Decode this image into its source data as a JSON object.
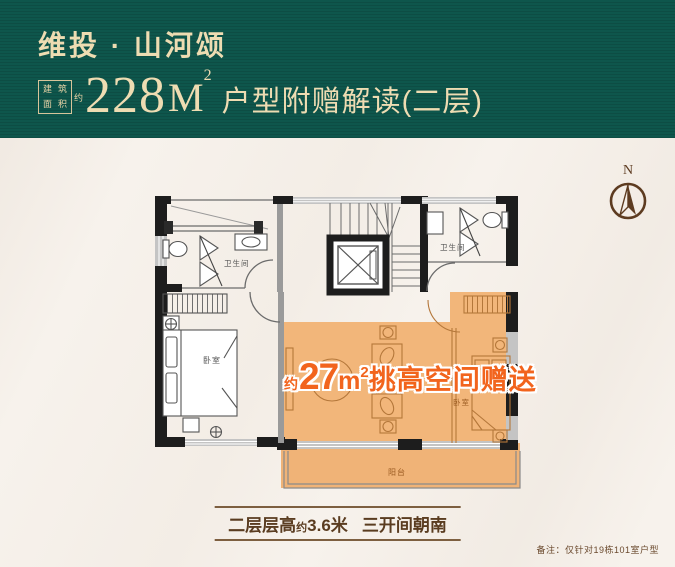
{
  "header": {
    "brand": "维投 · 山河颂",
    "seal_chars": [
      "建",
      "筑",
      "面",
      "积"
    ],
    "seal_approx": "约",
    "area_number": "228",
    "area_unit": "M",
    "area_sup": "2",
    "subtitle": "户型附赠解读(二层)"
  },
  "compass": {
    "label": "N"
  },
  "floorplan": {
    "rooms": {
      "bathroom_left": "卫生间",
      "bathroom_right": "卫生间",
      "bedroom_left": "卧室",
      "bedroom_right": "卧室",
      "balcony": "阳台"
    },
    "highlight": {
      "approx": "约",
      "number": "27",
      "unit": "m",
      "sup": "2",
      "text": "挑高空间赠送"
    }
  },
  "caption": {
    "part1": "二层层高",
    "approx": "约",
    "part2": "3.6米",
    "part3": "三开间朝南"
  },
  "remark": "备注：仅针对19栋101室户型",
  "colors": {
    "banner_green": "#0e564c",
    "banner_text": "#eedcb2",
    "highlight_orange": "#f2641d",
    "area_fill_orange": "#f2b67a",
    "caption_brown": "#5a3c20",
    "compass_brown": "#5d3b20"
  }
}
